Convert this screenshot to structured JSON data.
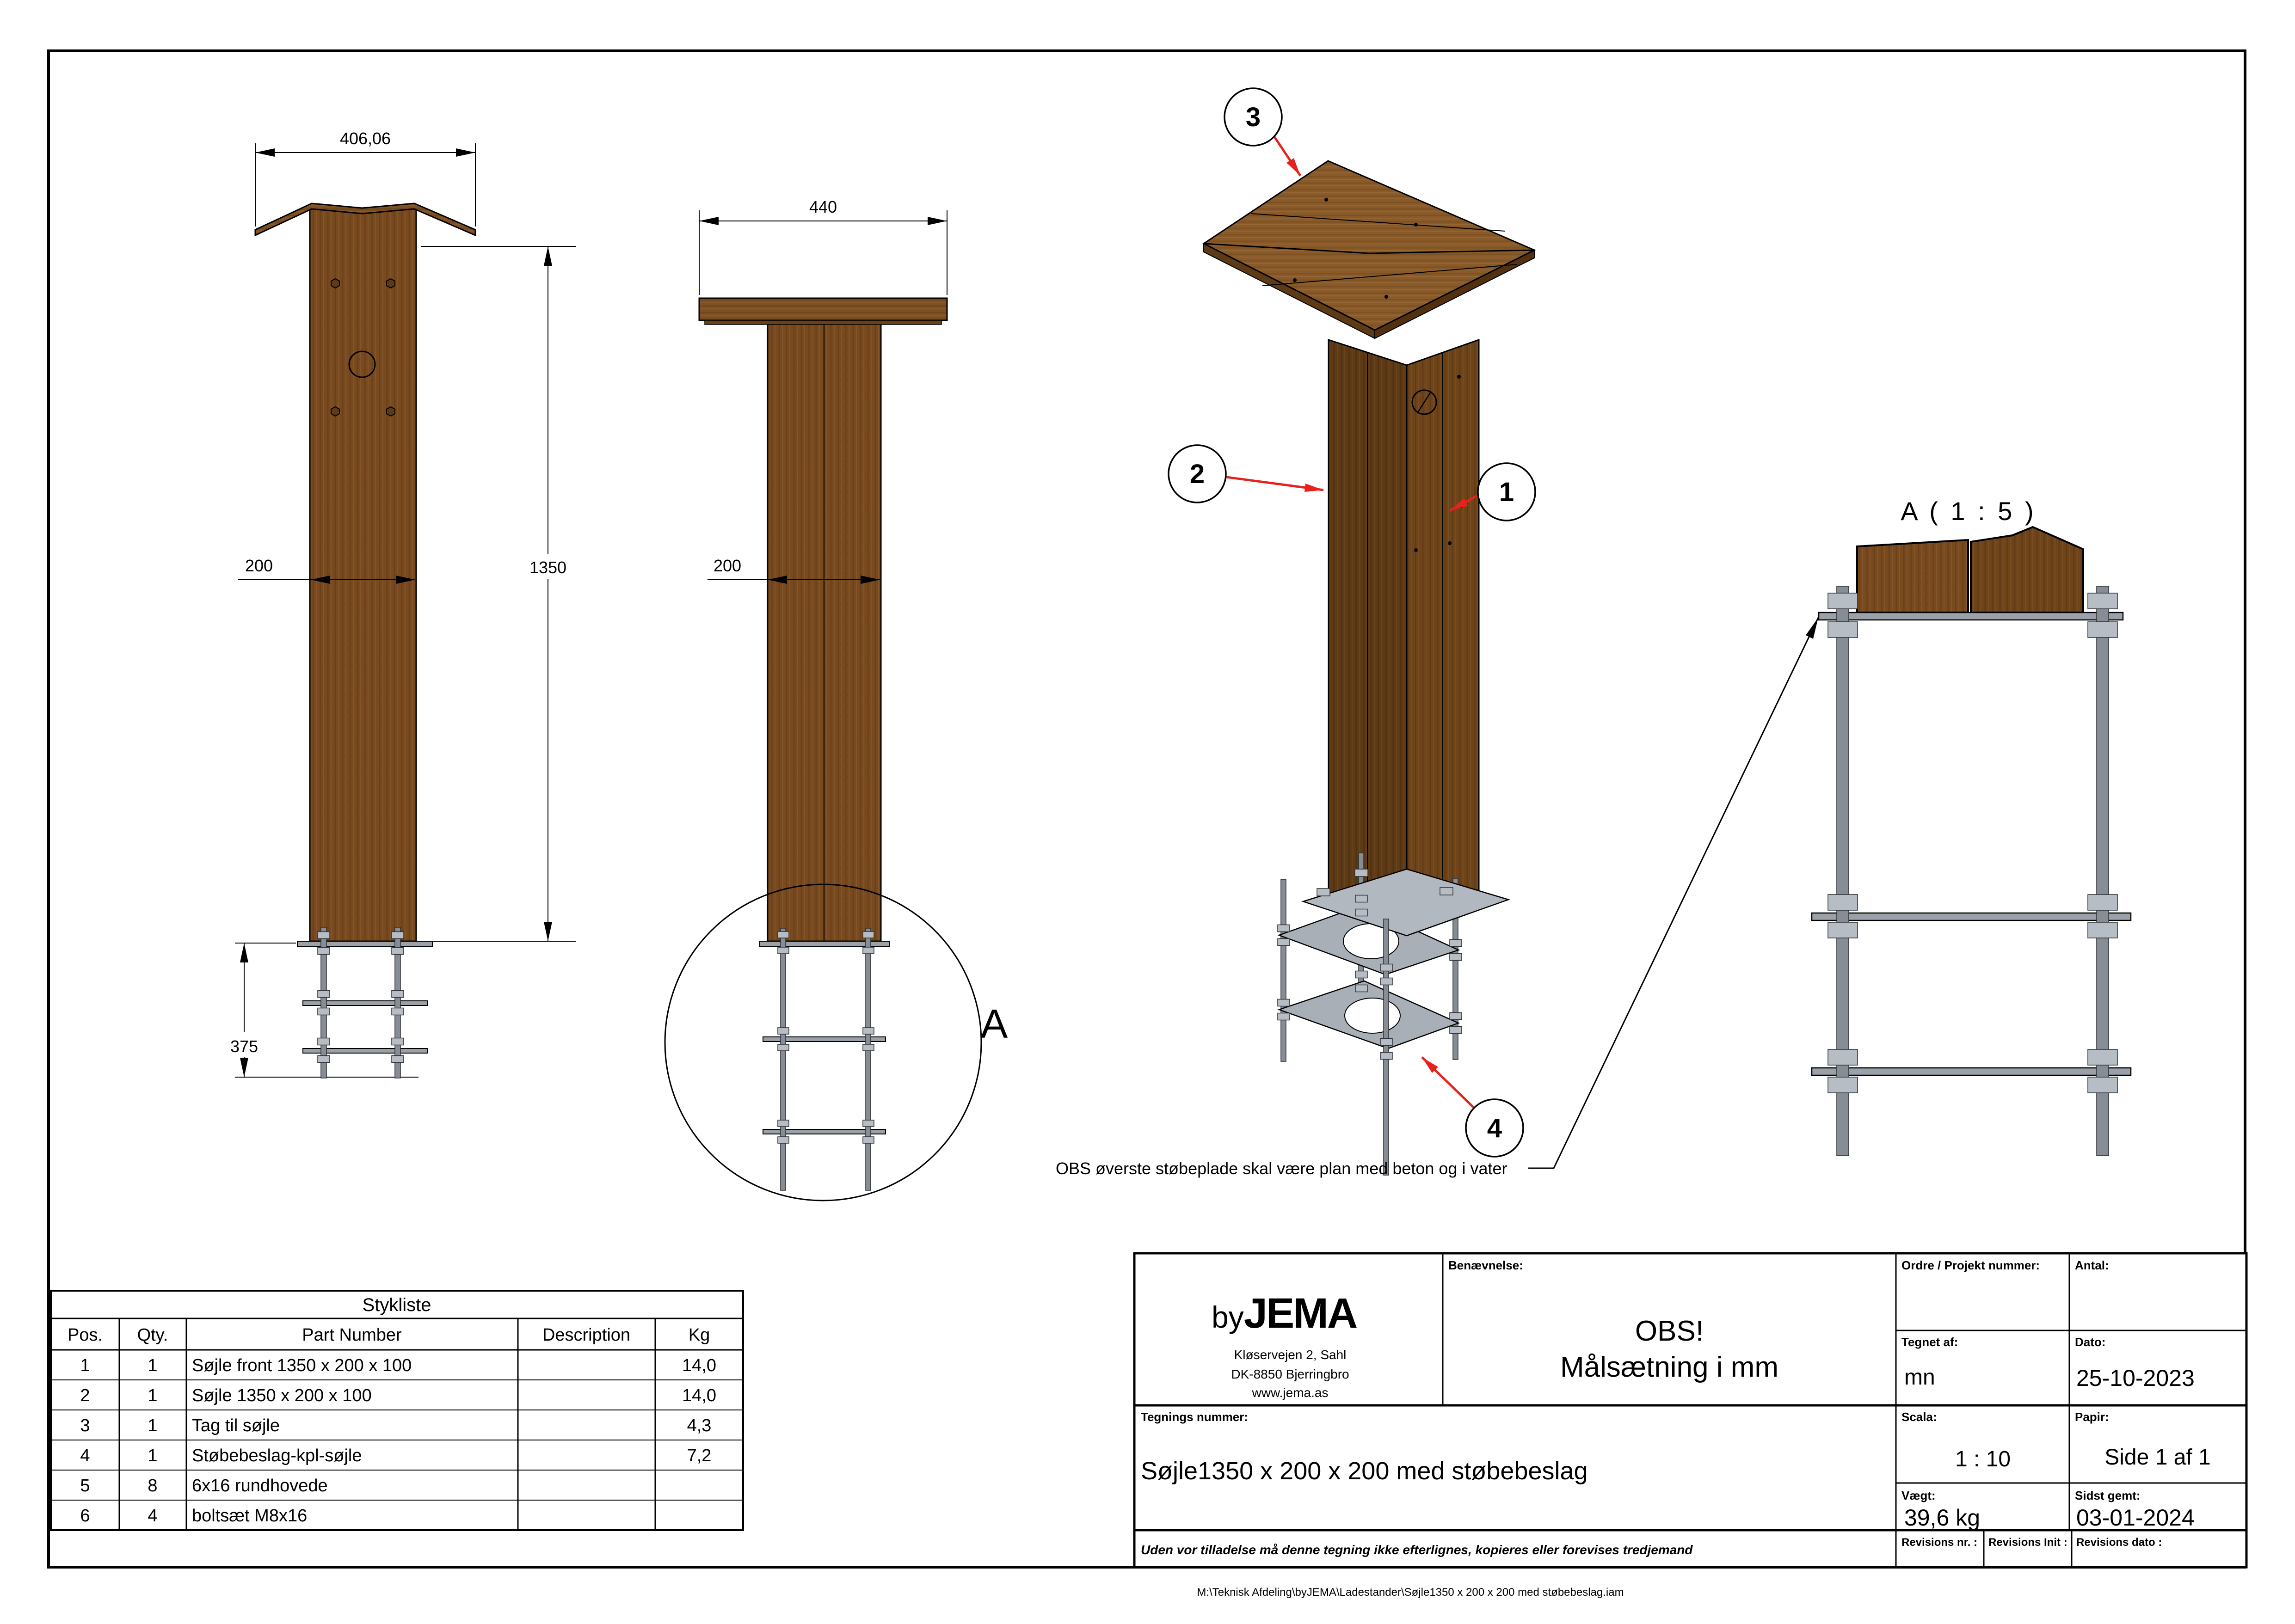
{
  "drawing": {
    "note": "OBS øverste støbeplade skal være plan med beton og i vater",
    "detail_label": "A",
    "detail_title": "A ( 1 : 5 )",
    "dims": {
      "front_width": "406,06",
      "front_face": "200",
      "height": "1350",
      "anchor": "375",
      "side_width": "440",
      "side_face": "200"
    },
    "balloons": [
      "1",
      "2",
      "3",
      "4"
    ]
  },
  "table": {
    "title": "Stykliste",
    "headers": [
      "Pos.",
      "Qty.",
      "Part Number",
      "Description",
      "Kg"
    ],
    "rows": [
      {
        "pos": "1",
        "qty": "1",
        "part": "Søjle front 1350 x 200 x 100",
        "desc": "",
        "kg": "14,0"
      },
      {
        "pos": "2",
        "qty": "1",
        "part": "Søjle 1350 x 200 x 100",
        "desc": "",
        "kg": "14,0"
      },
      {
        "pos": "3",
        "qty": "1",
        "part": "Tag til søjle",
        "desc": "",
        "kg": "4,3"
      },
      {
        "pos": "4",
        "qty": "1",
        "part": "Støbebeslag-kpl-søjle",
        "desc": "",
        "kg": "7,2"
      },
      {
        "pos": "5",
        "qty": "8",
        "part": "6x16 rundhovede",
        "desc": "",
        "kg": ""
      },
      {
        "pos": "6",
        "qty": "4",
        "part": "boltsæt M8x16",
        "desc": "",
        "kg": ""
      }
    ]
  },
  "title_block": {
    "labels": {
      "benaevnelse": "Benævnelse:",
      "ordre": "Ordre / Projekt nummer:",
      "antal": "Antal:",
      "tegnet_af": "Tegnet af:",
      "dato": "Dato:",
      "scala": "Scala:",
      "papir": "Papir:",
      "vaegt": "Vægt:",
      "sidst_gemt": "Sidst gemt:",
      "tegnings_nummer": "Tegnings nummer:",
      "rev_nr": "Revisions nr. :",
      "rev_init": "Revisions Init :",
      "rev_dato": "Revisions dato :"
    },
    "company": {
      "by": "by",
      "name": "JEMA",
      "address1": "Kløservejen 2, Sahl",
      "address2": "DK-8850 Bjerringbro",
      "website": "www.jema.as"
    },
    "values": {
      "benaevnelse1": "OBS!",
      "benaevnelse2": "Målsætning i mm",
      "tegnet_af": "mn",
      "dato": "25-10-2023",
      "scala": "1 : 10",
      "papir": "Side 1 af 1",
      "vaegt": "39,6 kg",
      "sidst_gemt": "03-01-2024",
      "tegnings_nummer": "Søjle1350 x 200 x 200 med støbebeslag"
    },
    "disclaimer": "Uden vor tilladelse må denne tegning ikke efterlignes, kopieres eller forevises tredjemand"
  },
  "footer": {
    "file_path": "M:\\Teknisk Afdeling\\byJEMA\\Ladestander\\Søjle1350 x 200 x 200 med støbebeslag.iam"
  },
  "colors": {
    "wood": "#7a4a1f",
    "wood_dark": "#5e3a15",
    "wood_roof": "#8a5a28",
    "steel": "#9ba1a8",
    "accent_red": "#e8211d",
    "detail_title": "#23234f"
  }
}
